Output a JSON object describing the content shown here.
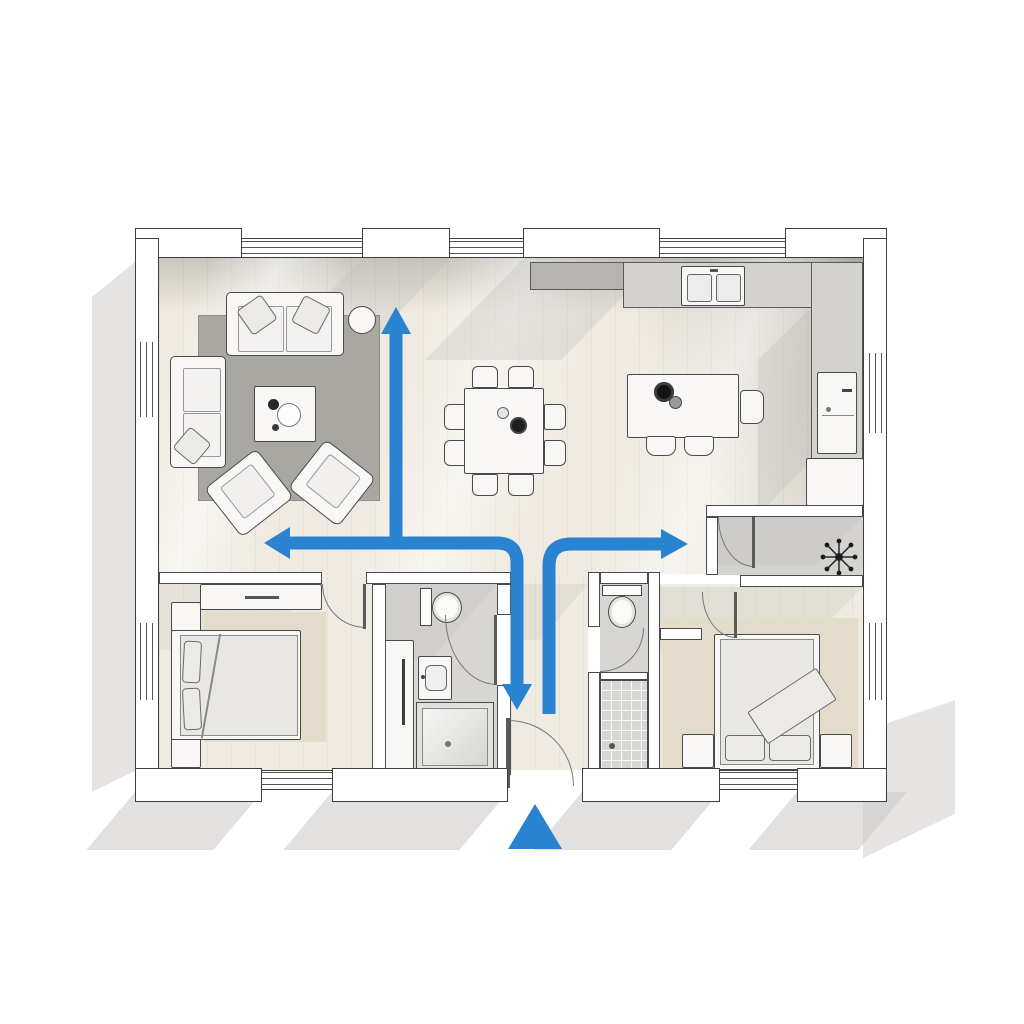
{
  "diagram": {
    "type": "floor-plan",
    "style": "3d-top-down-render",
    "description": "Single-storey house floor plan with blue circulation flow arrows starting at the front entrance",
    "entrance_marker": "blue triangle outside front door",
    "flow_arrows": [
      {
        "id": "flow-up",
        "direction": "up",
        "from": "central-junction",
        "to": "living-dining-area"
      },
      {
        "id": "flow-left",
        "direction": "left",
        "from": "central-junction",
        "to": "living-room"
      },
      {
        "id": "flow-down",
        "direction": "down",
        "from": "central-junction",
        "to": "entrance-hall"
      },
      {
        "id": "flow-right",
        "direction": "right",
        "from": "entrance-hall",
        "to": "kitchen-hallway"
      }
    ],
    "rooms": [
      {
        "id": "living-room",
        "contents": [
          "sofa",
          "loveseat",
          "coffee-table",
          "round-side-table",
          "armchair",
          "armchair",
          "gray-rug"
        ]
      },
      {
        "id": "dining-area",
        "contents": [
          "square-dining-table",
          "eight-chairs",
          "bowl",
          "carafe"
        ]
      },
      {
        "id": "kitchen",
        "contents": [
          "l-shaped-counter",
          "double-basin-sink",
          "island-with-cooktop",
          "bar-stools",
          "built-in-appliance",
          "base-cabinet"
        ]
      },
      {
        "id": "bedroom-1",
        "contents": [
          "double-bed",
          "two-pillows",
          "dresser",
          "two-nightstands",
          "wardrobe",
          "beige-carpet"
        ]
      },
      {
        "id": "bathroom-1",
        "contents": [
          "toilet",
          "washbasin",
          "shower-cabin"
        ]
      },
      {
        "id": "bathroom-2",
        "contents": [
          "toilet",
          "tiled-shower"
        ]
      },
      {
        "id": "bedroom-2",
        "contents": [
          "double-bed",
          "two-pillows",
          "throw-blanket",
          "two-nightstands",
          "beige-carpet"
        ]
      },
      {
        "id": "storage-room",
        "contents": [
          "ceiling-lamp-symbol"
        ]
      },
      {
        "id": "entrance-hall",
        "contents": [
          "front-door"
        ]
      }
    ],
    "windows": {
      "top-wall": 3,
      "left-wall": 2,
      "right-wall": 2,
      "bottom-wall": 2
    }
  },
  "palette": {
    "background": "#ffffff",
    "arrow_blue": "#2a83d0",
    "wall_fill": "#ffffff",
    "wall_outline": "#3e3e3e",
    "floor_wood": "#efebe2",
    "floor_shaded": "#d8d6d2",
    "rug_gray": "#a9a7a2",
    "carpet_beige": "#e4dccb",
    "counter_gray": "#d2d0cd",
    "shadow_gray": "#cbc9c6",
    "fixture_dark": "#222222"
  }
}
